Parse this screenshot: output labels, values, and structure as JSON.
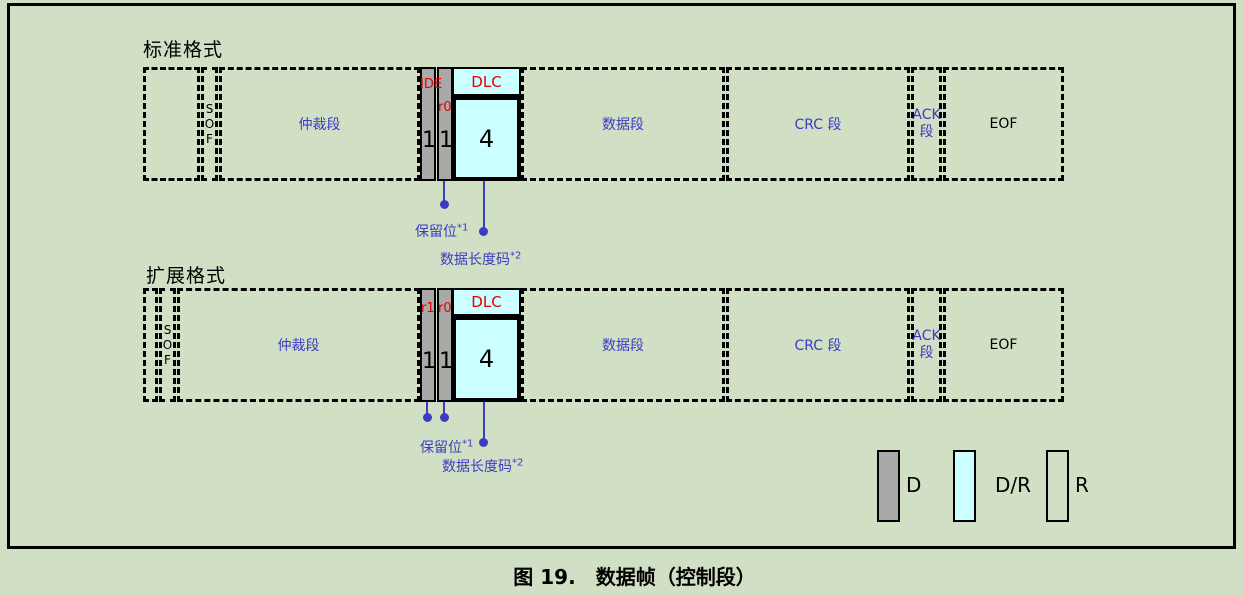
{
  "colors": {
    "background": "#d1dfc5",
    "border": "#000000",
    "bit_fill_dominant": "#a9a9a9",
    "dlc_fill": "#ccffff",
    "segment_label_blue": "#3c3cc2",
    "bit_label_red": "#e60000"
  },
  "frames": [
    {
      "title": "标准格式",
      "sof": "SOF",
      "arbitration": "仲裁段",
      "bits": [
        {
          "label": "IDE",
          "value": "1"
        },
        {
          "label": "r0",
          "value": "1"
        }
      ],
      "dlc": {
        "label": "DLC",
        "value": "4"
      },
      "data_segment": "数据段",
      "crc_segment": "CRC 段",
      "ack": [
        "ACK",
        "段"
      ],
      "eof": "EOF",
      "annotations": {
        "reserved_text": "保留位",
        "reserved_sup": "*1",
        "dlc_text": "数据长度码",
        "dlc_sup": "*2"
      }
    },
    {
      "title": "扩展格式",
      "sof": "SOF",
      "arbitration": "仲裁段",
      "bits": [
        {
          "label": "r1",
          "value": "1"
        },
        {
          "label": "r0",
          "value": "1"
        }
      ],
      "dlc": {
        "label": "DLC",
        "value": "4"
      },
      "data_segment": "数据段",
      "crc_segment": "CRC 段",
      "ack": [
        "ACK",
        "段"
      ],
      "eof": "EOF",
      "annotations": {
        "reserved_text": "保留位",
        "reserved_sup": "*1",
        "dlc_text": "数据长度码",
        "dlc_sup": "*2"
      }
    }
  ],
  "legend": {
    "items": [
      {
        "label": "D",
        "fill": "#a9a9a9"
      },
      {
        "label": "D/R",
        "fill": "#ccffff"
      },
      {
        "label": "R",
        "fill": "none"
      }
    ]
  },
  "caption": "图 19.　数据帧（控制段）"
}
